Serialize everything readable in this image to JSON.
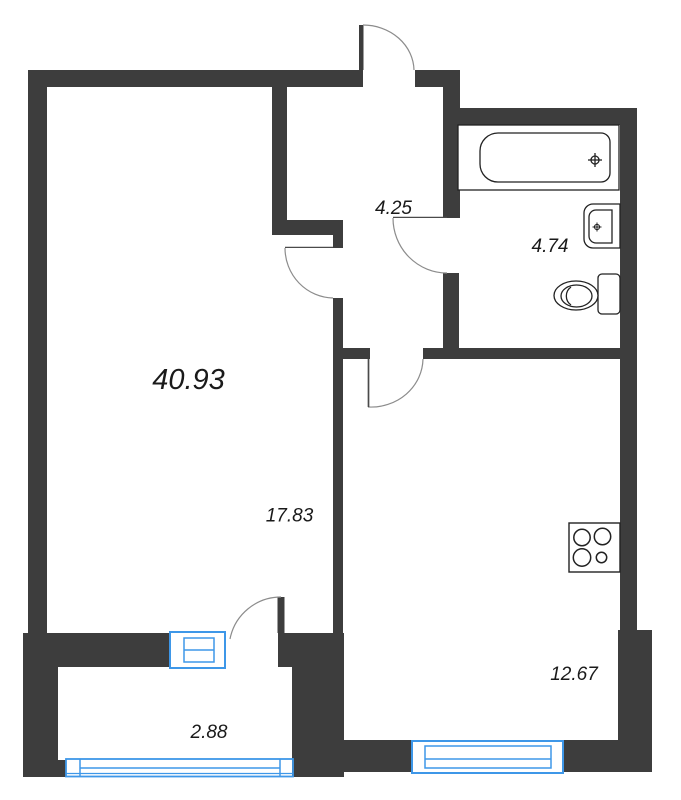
{
  "plan": {
    "type": "apartment-floor-plan",
    "labels": {
      "total_area": "40.93",
      "living_room": "17.83",
      "hallway": "4.25",
      "bathroom": "4.74",
      "kitchen": "12.67",
      "balcony": "2.88"
    },
    "colors": {
      "wall": "#3D3D3D",
      "window": "#3E97E8",
      "door_arc": "#8C8C8C",
      "door_leaf": "#4A4A4A",
      "fixture_outline": "#222222",
      "text": "#1A1A1A",
      "background": "#FFFFFF"
    },
    "fixtures": [
      "bathtub",
      "sink",
      "toilet",
      "stove"
    ],
    "windows": [
      "living-room-window",
      "kitchen-window",
      "balcony-glazing"
    ],
    "doors": [
      "entrance-door",
      "living-room-door",
      "bathroom-door",
      "kitchen-door",
      "balcony-door"
    ]
  }
}
